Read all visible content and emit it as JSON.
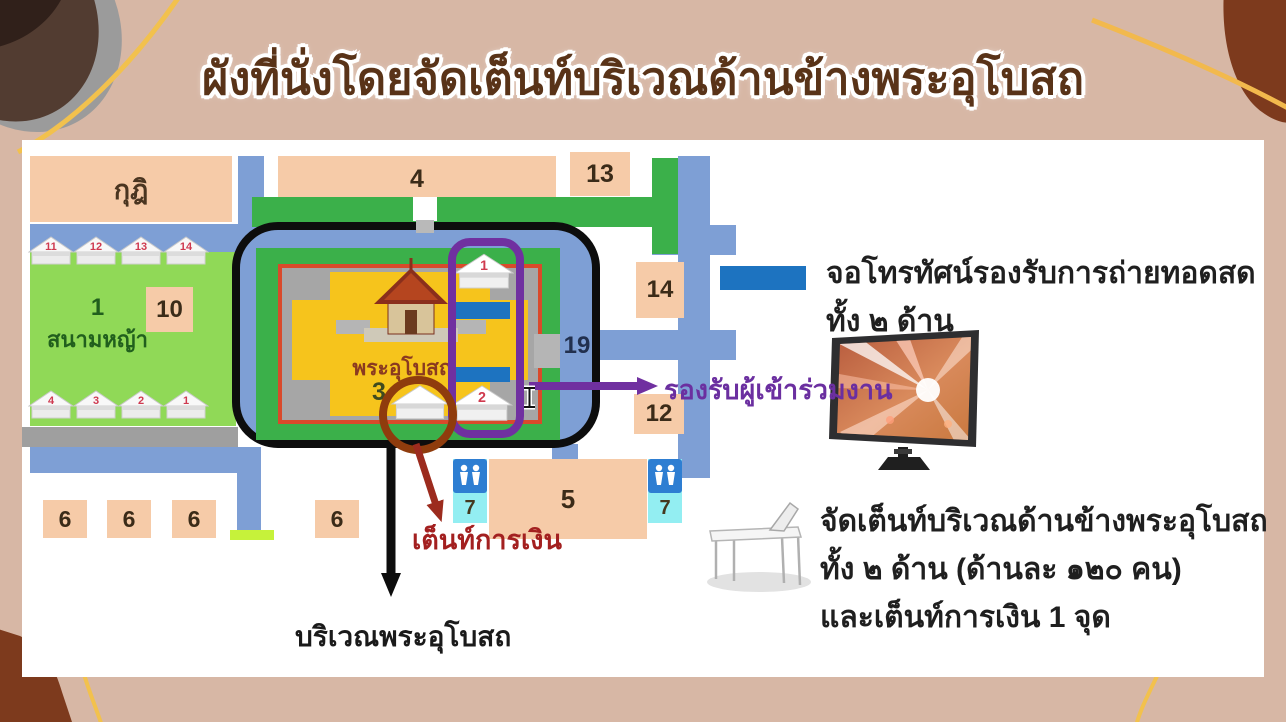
{
  "title": "ผังที่นั่งโดยจัดเต็นท์บริเวณด้านข้างพระอุโบสถ",
  "map": {
    "kuti": "กุฎิ",
    "building_4": "4",
    "building_13": "13",
    "building_10": "10",
    "building_14": "14",
    "building_12": "12",
    "building_5": "5",
    "building_6": "6",
    "restroom_7": "7",
    "road_19": "19",
    "lawn_number": "1",
    "lawn_label": "สนามหญ้า",
    "temple_label": "พระอุโบสถ",
    "spot_3": "3",
    "tent_1": "1",
    "tent_2": "2",
    "tents_top": [
      "11",
      "12",
      "13",
      "14"
    ],
    "tents_bottom": [
      "4",
      "3",
      "2",
      "1"
    ],
    "finance_tent_label": "เต็นท์การเงิน",
    "ubosot_area_label": "บริเวณพระอุโบสถ",
    "attendees_label": "รองรับผู้เข้าร่วมงาน"
  },
  "legend": {
    "tv_text_line1": "จอโทรทัศน์รองรับการถ่ายทอดสด",
    "tv_text_line2": "ทั้ง ๒ ด้าน",
    "tent_text_line1": "จัดเต็นท์บริเวณด้านข้างพระอุโบสถ",
    "tent_text_line2": "ทั้ง ๒ ด้าน (ด้านละ ๑๒๐ คน)",
    "tent_text_line3": "และเต็นท์การเงิน 1 จุด"
  },
  "colors": {
    "screen_blue": "#1d73c0",
    "road_blue": "#7e9fd5",
    "compound_green": "#3bb04a",
    "lawn_green": "#90d957",
    "building_peach": "#f6cba8",
    "highlight_purple": "#7030a0",
    "finance_red": "#9c2b1e",
    "title_brown": "#593318"
  }
}
